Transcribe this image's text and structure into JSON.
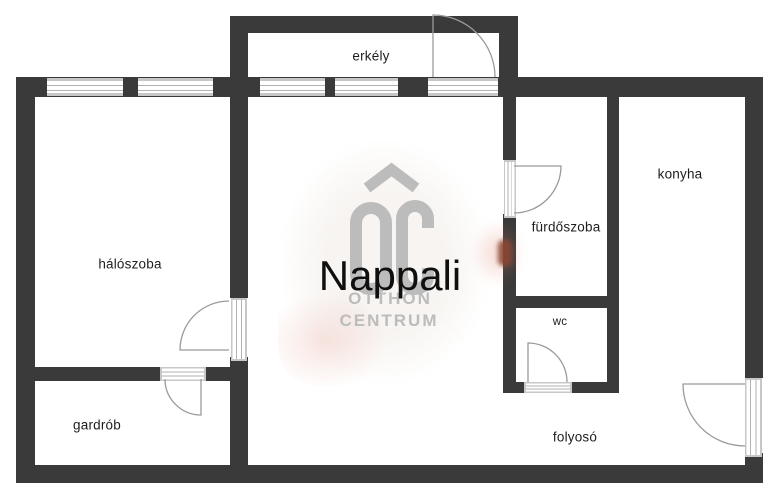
{
  "floorplan": {
    "rooms": [
      {
        "key": "erkely",
        "label": "erkély"
      },
      {
        "key": "haloszoba",
        "label": "hálószoba"
      },
      {
        "key": "nappali",
        "label": "Nappali"
      },
      {
        "key": "furdoszoba",
        "label": "fürdőszoba"
      },
      {
        "key": "konyha",
        "label": "konyha"
      },
      {
        "key": "wc",
        "label": "wc"
      },
      {
        "key": "gardrob",
        "label": "gardrób"
      },
      {
        "key": "folyoso",
        "label": "folyosó"
      }
    ],
    "watermark": {
      "logo_text": "OC",
      "line1": "OTTHON",
      "line2": "CENTRUM"
    },
    "colors": {
      "wall": "#3a3a3a",
      "window_frame": "#c7c7c7",
      "door_line": "#9a9a9a",
      "label": "#1d1d1d",
      "watermark": "#bcbcbc",
      "background": "#ffffff",
      "accent_smudge": "#8a4632"
    }
  }
}
